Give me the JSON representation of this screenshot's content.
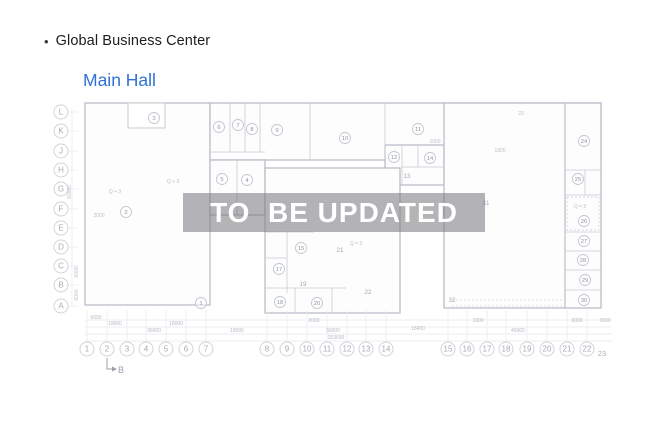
{
  "header": {
    "bullet": "•",
    "title": "Global Business Center",
    "subtitle": "Main Hall"
  },
  "watermark": {
    "text": "TO  BE UPDATED"
  },
  "plan": {
    "colors": {
      "left_zone": "#cbd4de",
      "middle_zone": "#b6cbeb",
      "right_zone": "#ecd0d8",
      "accent_blue": "#2e71d6"
    },
    "section_marker": {
      "label": "B"
    },
    "row_axis": [
      {
        "label": "L",
        "y": 112
      },
      {
        "label": "K",
        "y": 131
      },
      {
        "label": "J",
        "y": 151
      },
      {
        "label": "H",
        "y": 170
      },
      {
        "label": "G",
        "y": 189
      },
      {
        "label": "F",
        "y": 209
      },
      {
        "label": "E",
        "y": 228
      },
      {
        "label": "D",
        "y": 247
      },
      {
        "label": "C",
        "y": 266
      },
      {
        "label": "B",
        "y": 285
      },
      {
        "label": "A",
        "y": 306
      }
    ],
    "col_axis": [
      {
        "label": "1",
        "x": 87
      },
      {
        "label": "2",
        "x": 107
      },
      {
        "label": "3",
        "x": 127
      },
      {
        "label": "4",
        "x": 146
      },
      {
        "label": "5",
        "x": 166
      },
      {
        "label": "6",
        "x": 186
      },
      {
        "label": "7",
        "x": 206
      },
      {
        "label": "8",
        "x": 267
      },
      {
        "label": "9",
        "x": 287
      },
      {
        "label": "10",
        "x": 307
      },
      {
        "label": "11",
        "x": 327
      },
      {
        "label": "12",
        "x": 347
      },
      {
        "label": "13",
        "x": 366
      },
      {
        "label": "14",
        "x": 386
      },
      {
        "label": "15",
        "x": 448
      },
      {
        "label": "16",
        "x": 467
      },
      {
        "label": "17",
        "x": 487
      },
      {
        "label": "18",
        "x": 506
      },
      {
        "label": "19",
        "x": 527
      },
      {
        "label": "20",
        "x": 547
      },
      {
        "label": "21",
        "x": 567
      },
      {
        "label": "22",
        "x": 587
      },
      {
        "label": "23",
        "x": 602,
        "plain": true
      }
    ],
    "rooms": [
      {
        "n": "1",
        "x": 201,
        "y": 303
      },
      {
        "n": "2",
        "x": 126,
        "y": 212
      },
      {
        "n": "3",
        "x": 154,
        "y": 118
      },
      {
        "n": "4",
        "x": 247,
        "y": 180
      },
      {
        "n": "5",
        "x": 222,
        "y": 179
      },
      {
        "n": "6",
        "x": 219,
        "y": 127
      },
      {
        "n": "7",
        "x": 238,
        "y": 125
      },
      {
        "n": "8",
        "x": 252,
        "y": 129
      },
      {
        "n": "9",
        "x": 277,
        "y": 130
      },
      {
        "n": "10",
        "x": 345,
        "y": 138
      },
      {
        "n": "11",
        "x": 418,
        "y": 129
      },
      {
        "n": "12",
        "x": 394,
        "y": 157
      },
      {
        "n": "13",
        "x": 407,
        "y": 176,
        "plain": true
      },
      {
        "n": "14",
        "x": 430,
        "y": 158
      },
      {
        "n": "15",
        "x": 301,
        "y": 248
      },
      {
        "n": "17",
        "x": 279,
        "y": 269
      },
      {
        "n": "18",
        "x": 280,
        "y": 302
      },
      {
        "n": "19",
        "x": 303,
        "y": 284,
        "plain": true
      },
      {
        "n": "20",
        "x": 317,
        "y": 303
      },
      {
        "n": "21",
        "x": 340,
        "y": 250,
        "plain": true
      },
      {
        "n": "22",
        "x": 368,
        "y": 292,
        "plain": true
      },
      {
        "n": "24",
        "x": 584,
        "y": 141
      },
      {
        "n": "25",
        "x": 578,
        "y": 179
      },
      {
        "n": "26",
        "x": 584,
        "y": 221
      },
      {
        "n": "27",
        "x": 584,
        "y": 241
      },
      {
        "n": "28",
        "x": 583,
        "y": 260
      },
      {
        "n": "29",
        "x": 585,
        "y": 280
      },
      {
        "n": "30",
        "x": 584,
        "y": 300
      },
      {
        "n": "31",
        "x": 486,
        "y": 203,
        "plain": true
      },
      {
        "n": "32",
        "x": 452,
        "y": 300,
        "plain": true
      }
    ],
    "annotations": [
      {
        "t": "2000",
        "x": 99,
        "y": 217
      },
      {
        "t": "Q + 3",
        "x": 173,
        "y": 183
      },
      {
        "t": "Q + 3",
        "x": 115,
        "y": 193
      },
      {
        "t": "Q = 3",
        "x": 356,
        "y": 245
      },
      {
        "t": "Q = 3",
        "x": 580,
        "y": 208
      },
      {
        "t": "1000",
        "x": 435,
        "y": 143
      },
      {
        "t": "1800",
        "x": 500,
        "y": 152
      },
      {
        "t": "23",
        "x": 521,
        "y": 115
      },
      {
        "t": "60000",
        "x": 71,
        "y": 192,
        "vert": true
      },
      {
        "t": "6000",
        "x": 78,
        "y": 272,
        "vert": true
      },
      {
        "t": "6000",
        "x": 78,
        "y": 295,
        "vert": true
      }
    ],
    "dimensions": [
      {
        "t": "6000",
        "x": 96,
        "y": 319
      },
      {
        "t": "18000",
        "x": 115,
        "y": 325
      },
      {
        "t": "18000",
        "x": 176,
        "y": 325
      },
      {
        "t": "36000",
        "x": 154,
        "y": 332
      },
      {
        "t": "18000",
        "x": 237,
        "y": 332
      },
      {
        "t": "2000",
        "x": 314,
        "y": 322
      },
      {
        "t": "36000",
        "x": 333,
        "y": 332
      },
      {
        "t": "153600",
        "x": 336,
        "y": 339
      },
      {
        "t": "18400",
        "x": 418,
        "y": 330
      },
      {
        "t": "1000",
        "x": 478,
        "y": 322
      },
      {
        "t": "45000",
        "x": 518,
        "y": 332
      },
      {
        "t": "6000",
        "x": 577,
        "y": 322
      },
      {
        "t": "3000",
        "x": 605,
        "y": 322
      }
    ]
  }
}
